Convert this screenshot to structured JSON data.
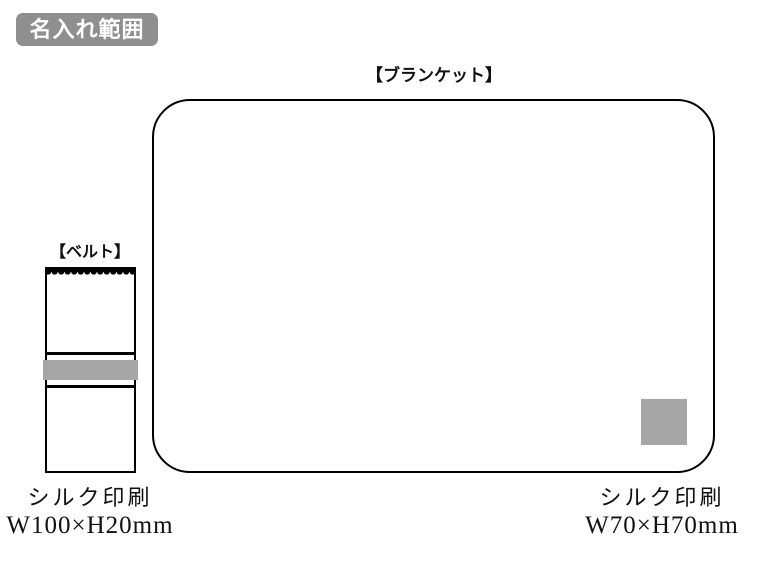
{
  "badge": {
    "label": "名入れ範囲"
  },
  "blanket": {
    "label": "【ブランケット】",
    "print_area": {
      "method": "シルク印刷",
      "size": "W70×H70mm"
    }
  },
  "belt": {
    "label": "【ベルト】",
    "print_area": {
      "method": "シルク印刷",
      "size": "W100×H20mm"
    }
  },
  "colors": {
    "badge_bg": "#8f8f8f",
    "badge_text": "#ffffff",
    "print_gray": "#a6a6a6",
    "outline": "#000000"
  }
}
